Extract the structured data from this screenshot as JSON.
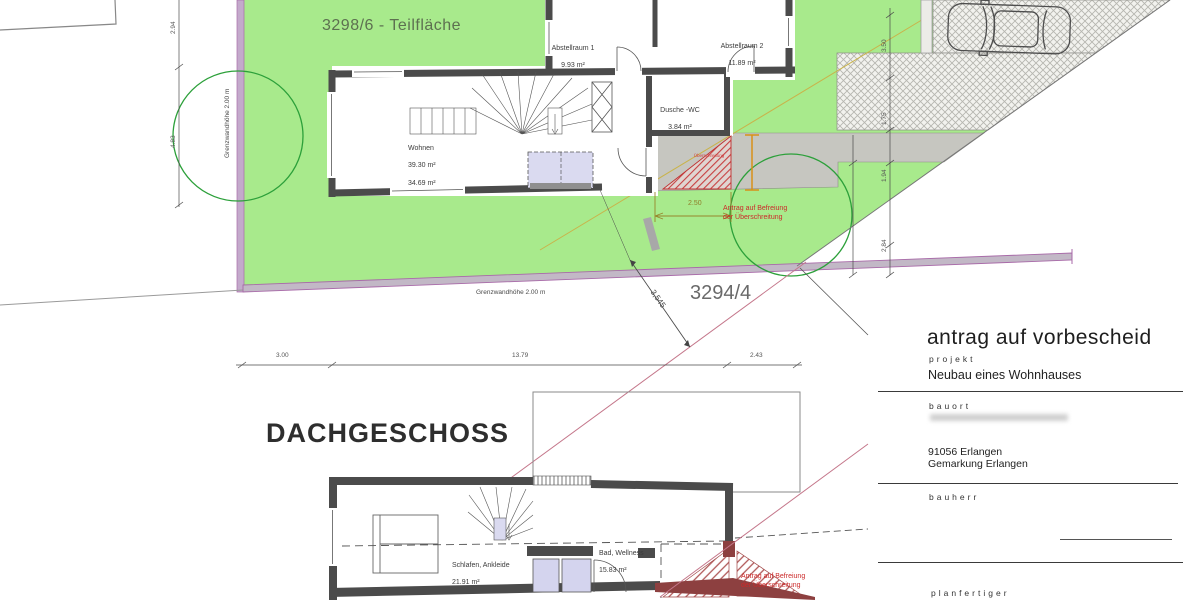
{
  "site_plan": {
    "parcel_main": "3298/6 - Teilfläche",
    "parcel_neighbor": "3294/4",
    "wall_note_left": "Grenzwandhöhe 2.00 m",
    "wall_note_bottom": "Grenzwandhöhe 2.00 m",
    "rooms": [
      {
        "name": "Abstellraum 1",
        "area": "9.93 m²"
      },
      {
        "name": "Abstellraum 2",
        "area": "11.89 m²"
      },
      {
        "name": "Dusche -WC",
        "area": "3.84 m²"
      },
      {
        "name": "Wohnen",
        "area": "39.30 m²",
        "area2": "34.69 m²"
      }
    ],
    "exceedance_note": "Antrag auf Befreiung\nder Überschreitung",
    "exceedance_area_label": "Überschreitung",
    "dims": {
      "left_upper": "2.94",
      "left_lower": "4.83",
      "bottom_1": "3.00",
      "bottom_2": "13.79",
      "bottom_3": "2.43",
      "diagonal": "3,545",
      "entry_width": "2.50",
      "right_1": "3.50",
      "right_2": "1.75",
      "right_3": "1.94",
      "right_4": "2.84"
    }
  },
  "attic_plan": {
    "title": "DACHGESCHOSS",
    "rooms": [
      {
        "name": "Schlafen, Ankleide",
        "area": "21.91 m²"
      },
      {
        "name": "Bad, Wellness",
        "area": "15.83 m²"
      }
    ],
    "exceedance_note": "Antrag auf Befreiung\nder Überschreitung"
  },
  "title_block": {
    "title": "antrag auf vorbescheid",
    "project_label": "projekt",
    "project_name": "Neubau eines Wohnhauses",
    "location_label": "bauort",
    "location_postal": "91056 Erlangen",
    "location_district": "Gemarkung Erlangen",
    "client_label": "bauherr",
    "planner_label": "planfertiger"
  },
  "colors": {
    "plot_green": "#a8ea8c",
    "wall_gray": "#4b4b4b",
    "boundary_magenta": "#a86aa8",
    "alert_red": "#cc2a2a",
    "deep_red": "#8d4040",
    "tree_green": "#2ca03a"
  }
}
